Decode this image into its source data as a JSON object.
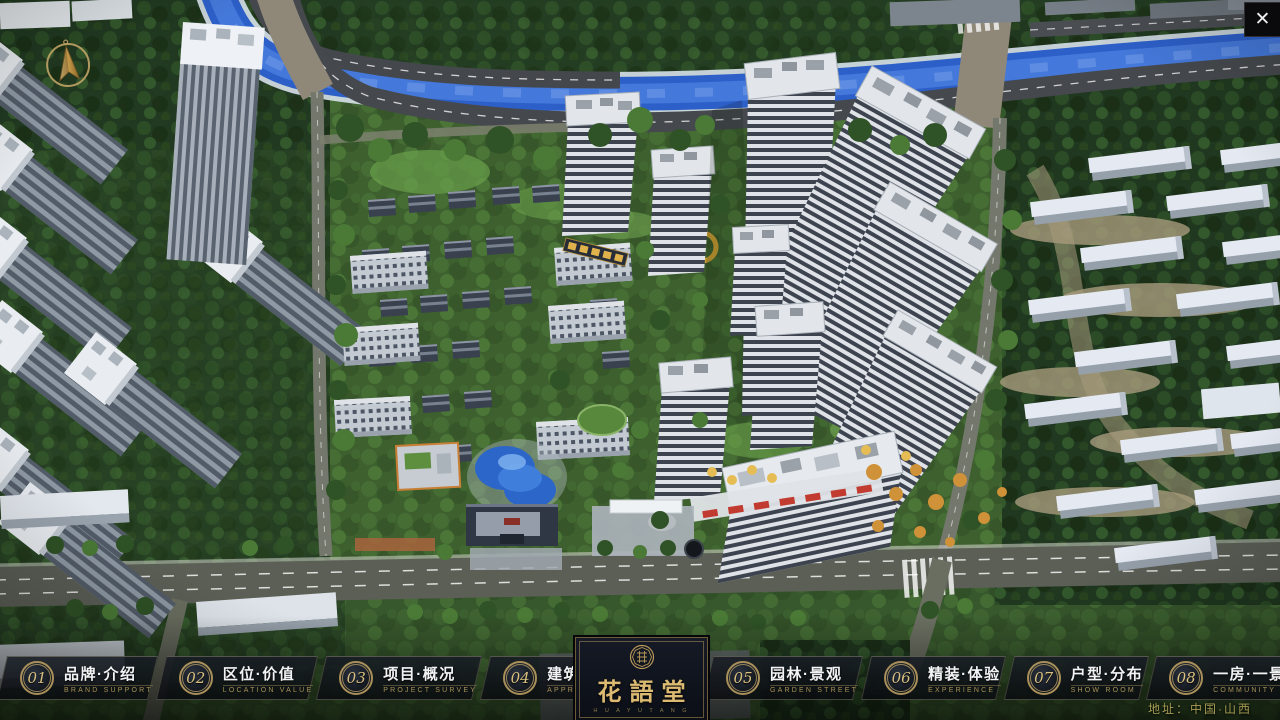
{
  "app": {
    "type": "real-estate-presentation",
    "address": "地址：中国·山西"
  },
  "window": {
    "close_glyph": "✕"
  },
  "logo": {
    "name_cn": "花語堂",
    "name_en": "H U A   Y U   T A N G"
  },
  "navbar": {
    "items": [
      {
        "num": "01",
        "cn": "品牌·介绍",
        "en": "BRAND SUPPORT"
      },
      {
        "num": "02",
        "cn": "区位·价值",
        "en": "LOCATION VALUE"
      },
      {
        "num": "03",
        "cn": "项目·概况",
        "en": "PROJECT SURVEY"
      },
      {
        "num": "04",
        "cn": "建筑·鉴赏",
        "en": "APPRECIATION"
      },
      {
        "num": "05",
        "cn": "园林·景观",
        "en": "GARDEN STREET"
      },
      {
        "num": "06",
        "cn": "精装·体验",
        "en": "EXPERIENCE"
      },
      {
        "num": "07",
        "cn": "户型·分布",
        "en": "SHOW ROOM"
      },
      {
        "num": "08",
        "cn": "一房·一景",
        "en": "COMMUNITY"
      }
    ]
  },
  "icons": {
    "compass": "compass-north-icon",
    "close": "close-icon",
    "seal": "brand-seal-icon"
  },
  "colors": {
    "gold": "#c9a96a",
    "panel_navy": "#10141c",
    "river_blue": "#2d5fc8",
    "forest_green": "#203820",
    "roof_white": "#e6eaee",
    "accent_red": "#c23b31"
  }
}
